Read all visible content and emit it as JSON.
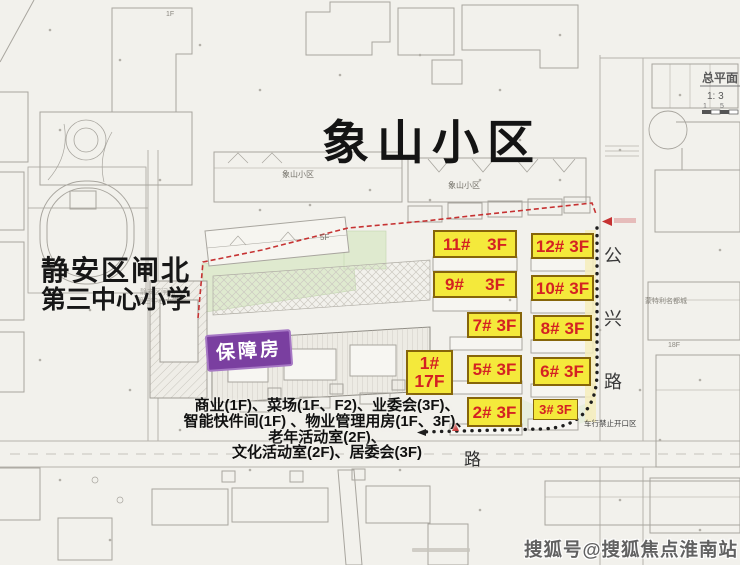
{
  "title": "象山小区",
  "school": {
    "line1": "静安区闸北",
    "line2": "第三中心小学"
  },
  "affordable_label": "保障房",
  "buildings": [
    {
      "id": "11#",
      "floors": "3F"
    },
    {
      "id": "12#",
      "floors": "3F"
    },
    {
      "id": "9#",
      "floors": "3F"
    },
    {
      "id": "10#",
      "floors": "3F"
    },
    {
      "id": "7#",
      "floors": "3F"
    },
    {
      "id": "8#",
      "floors": "3F"
    },
    {
      "id": "1#",
      "floors": "17F"
    },
    {
      "id": "5#",
      "floors": "3F"
    },
    {
      "id": "6#",
      "floors": "3F"
    },
    {
      "id": "2#",
      "floors": "3F"
    },
    {
      "id": "3#",
      "floors": "3F"
    }
  ],
  "facilities": {
    "line1": "商业(1F)、菜场(1F、F2)、业委会(3F)、",
    "line2": "智能快件间(1F) 、物业管理用房(1F、3F)、",
    "line3": "老年活动室(2F)、",
    "line4": "文化活动室(2F)、居委会(3F)"
  },
  "roads": {
    "gongxing": [
      "公",
      "兴",
      "路"
    ],
    "south_road": "路"
  },
  "small_labels": {
    "xiangshan_a": "象山小区",
    "xiangshan_b": "象山小区",
    "floor_1f": "1F",
    "floor_5f": "5F",
    "floor_18f": "18F",
    "mengteli": "蒙特利名都城",
    "no_vehicle_opening": "车行禁止开口区",
    "school_small_1": "静安区闸北",
    "school_small_2": "第三中心小学"
  },
  "titleblock": {
    "plan_name": "总平面",
    "scale": "1: 3",
    "tick_a": "1",
    "tick_b": "5"
  },
  "watermark": "搜狐号@搜狐焦点淮南站",
  "colors": {
    "label_bg": "#f4e93b",
    "label_text": "#d42222",
    "purple": "#7a3fa0",
    "boundary_red": "#c63232"
  }
}
